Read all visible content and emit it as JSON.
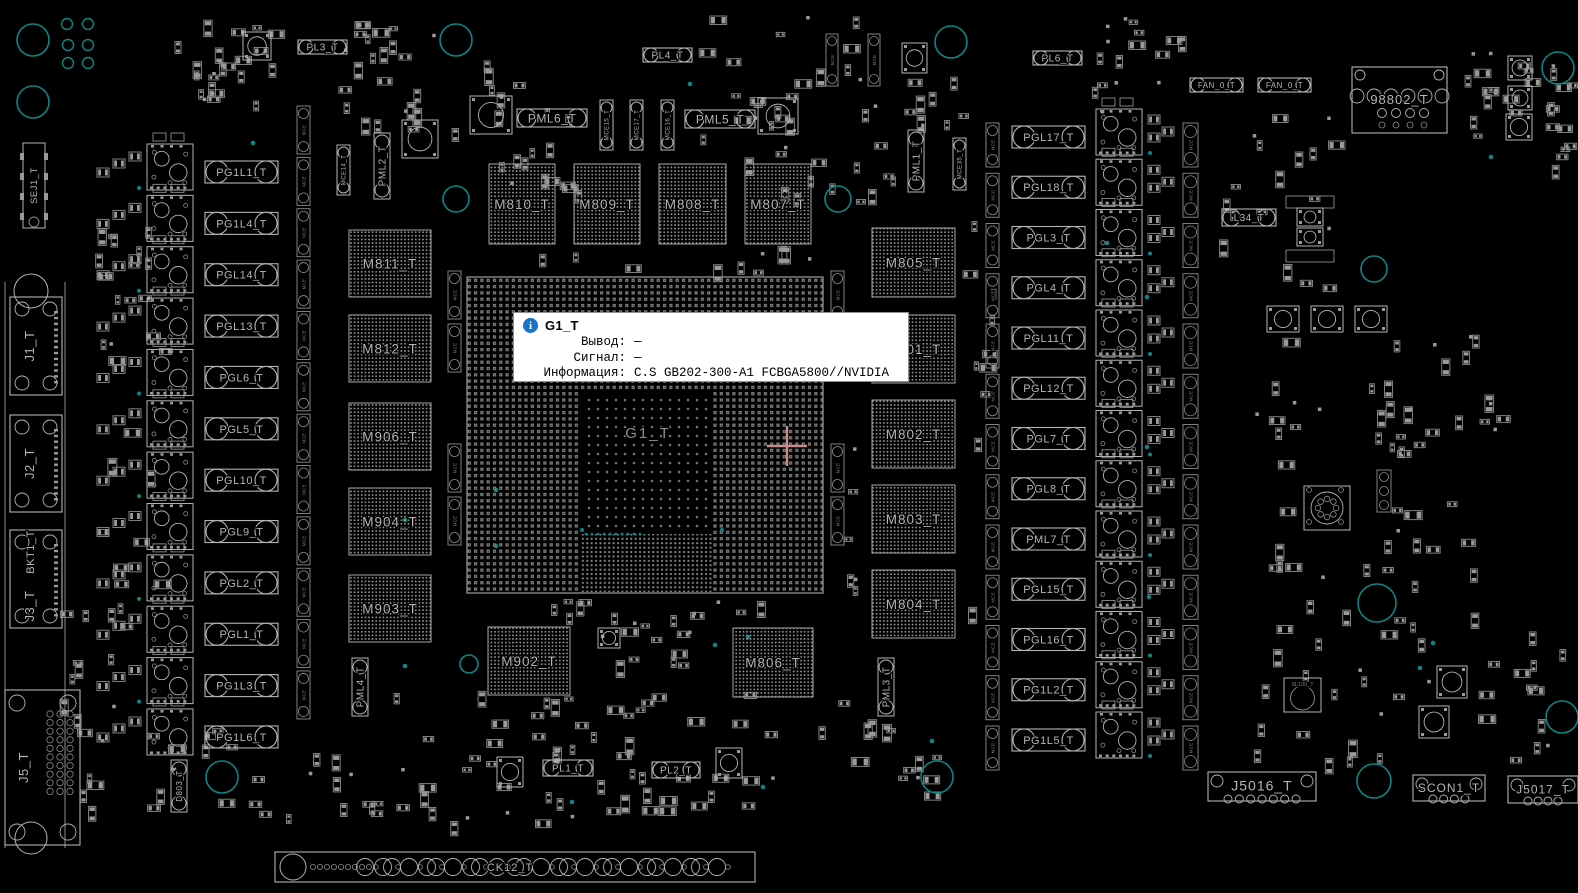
{
  "colors": {
    "bg": "#000000",
    "outline": "#b4b4b4",
    "dim": "#8d8d8d",
    "pad": "#9a9a9a",
    "label": "#b6b6b6",
    "faint": "#7e7e7e",
    "teal": "#0d8585",
    "crosshair": "#c98b8b",
    "tooltip_bg": "#ffffff",
    "tooltip_border": "#8f8f8f",
    "tooltip_text": "#000000",
    "info_icon_bg": "#1774c9"
  },
  "tooltip": {
    "x": 513,
    "y": 312,
    "w": 396,
    "h": 70,
    "title": "G1_T",
    "rows": [
      {
        "label": "Вывод:",
        "value": "—"
      },
      {
        "label": "Сигнал:",
        "value": "—"
      },
      {
        "label": "Информация:",
        "value": "C.S GB202-300-A1 FCBGA5800//NVIDIA"
      }
    ]
  },
  "gpu": {
    "label": "G1_T",
    "x": 467,
    "y": 277,
    "w": 356,
    "h": 316,
    "die": {
      "x": 580,
      "y": 390,
      "w": 132,
      "h": 142
    },
    "fine": {
      "x": 580,
      "y": 532,
      "w": 132,
      "h": 60
    },
    "crosshair": {
      "x": 787,
      "y": 446,
      "arm": 20
    }
  },
  "memory": [
    {
      "label": "M810_T",
      "x": 489,
      "y": 164,
      "w": 66,
      "h": 80
    },
    {
      "label": "M809_T",
      "x": 574,
      "y": 164,
      "w": 66,
      "h": 80
    },
    {
      "label": "M808_T",
      "x": 659,
      "y": 164,
      "w": 67,
      "h": 80
    },
    {
      "label": "M807_T",
      "x": 745,
      "y": 164,
      "w": 66,
      "h": 80
    },
    {
      "label": "M811_T",
      "x": 349,
      "y": 230,
      "w": 82,
      "h": 67
    },
    {
      "label": "M812_T",
      "x": 349,
      "y": 315,
      "w": 82,
      "h": 67
    },
    {
      "label": "M906_T",
      "x": 349,
      "y": 403,
      "w": 82,
      "h": 67
    },
    {
      "label": "M904_T",
      "x": 349,
      "y": 488,
      "w": 82,
      "h": 67
    },
    {
      "label": "M903_T",
      "x": 349,
      "y": 575,
      "w": 82,
      "h": 67
    },
    {
      "label": "M805_T",
      "x": 872,
      "y": 228,
      "w": 83,
      "h": 69
    },
    {
      "label": "M801_T",
      "x": 872,
      "y": 315,
      "w": 83,
      "h": 68
    },
    {
      "label": "M802_T",
      "x": 872,
      "y": 400,
      "w": 83,
      "h": 68
    },
    {
      "label": "M803_T",
      "x": 872,
      "y": 485,
      "w": 83,
      "h": 68
    },
    {
      "label": "M804_T",
      "x": 872,
      "y": 570,
      "w": 83,
      "h": 68
    },
    {
      "label": "M902_T",
      "x": 488,
      "y": 627,
      "w": 82,
      "h": 68
    },
    {
      "label": "M806_T",
      "x": 733,
      "y": 628,
      "w": 80,
      "h": 69
    }
  ],
  "left_phases": {
    "pill_x": 205,
    "pill_w": 73,
    "pill_h": 22,
    "drmos_x": 147,
    "y0": 172,
    "step": 51.36,
    "labels": [
      "PG1L1_T",
      "PG1L4_T",
      "PGL14_T",
      "PGL13_T",
      "PGL6_T",
      "PGL5_T",
      "PGL10_T",
      "PGL9_T",
      "PGL2_T",
      "PGL1_T",
      "PG1L3_T",
      "PG1L6_T"
    ]
  },
  "right_phases": {
    "pill_x": 1012,
    "pill_w": 73,
    "pill_h": 22,
    "drmos_x": 1096,
    "y0": 137,
    "step": 50.25,
    "labels": [
      "PGL17_T",
      "PGL18_T",
      "PGL3_T",
      "PGL4_T",
      "PGL11_T",
      "PGL12_T",
      "PGL7_T",
      "PGL8_T",
      "PML7_T",
      "PGL15_T",
      "PGL16_T",
      "PG1L2_T",
      "PG1L5_T"
    ]
  },
  "pills": [
    {
      "label": "PL3_T",
      "x": 298,
      "y": 40,
      "w": 49,
      "h": 14,
      "fs": 10
    },
    {
      "label": "PL4_T",
      "x": 643,
      "y": 48,
      "w": 49,
      "h": 14,
      "fs": 10
    },
    {
      "label": "PL6_T",
      "x": 1033,
      "y": 51,
      "w": 49,
      "h": 14,
      "fs": 10
    },
    {
      "label": "PML6_T",
      "x": 517,
      "y": 109,
      "w": 70,
      "h": 18,
      "fs": 12
    },
    {
      "label": "PML5_T",
      "x": 685,
      "y": 110,
      "w": 70,
      "h": 18,
      "fs": 12
    },
    {
      "label": "PL1_T",
      "x": 543,
      "y": 760,
      "w": 50,
      "h": 16,
      "fs": 10
    },
    {
      "label": "PL2_T",
      "x": 652,
      "y": 762,
      "w": 48,
      "h": 16,
      "fs": 10
    },
    {
      "label": "FAN_0_T",
      "x": 1190,
      "y": 78,
      "w": 53,
      "h": 14,
      "fs": 8
    },
    {
      "label": "FAN_0_T",
      "x": 1258,
      "y": 78,
      "w": 53,
      "h": 14,
      "fs": 8
    },
    {
      "label": "L34_T",
      "x": 1222,
      "y": 209,
      "w": 54,
      "h": 17,
      "fs": 10
    }
  ],
  "vpills": [
    {
      "label": "PML2_T",
      "x": 374,
      "y": 133,
      "w": 16,
      "h": 66,
      "fs": 10
    },
    {
      "label": "PML1_T",
      "x": 908,
      "y": 130,
      "w": 16,
      "h": 62,
      "fs": 10
    },
    {
      "label": "PML4_T",
      "x": 352,
      "y": 658,
      "w": 16,
      "h": 58,
      "fs": 10
    },
    {
      "label": "PML3_T",
      "x": 878,
      "y": 658,
      "w": 16,
      "h": 58,
      "fs": 10
    },
    {
      "label": "D803_T",
      "x": 171,
      "y": 760,
      "w": 16,
      "h": 52,
      "fs": 8
    },
    {
      "label": "MCE15_T",
      "x": 600,
      "y": 100,
      "w": 13,
      "h": 50,
      "fs": 6
    },
    {
      "label": "MCE17_T",
      "x": 630,
      "y": 100,
      "w": 13,
      "h": 50,
      "fs": 6
    },
    {
      "label": "MCE16_T",
      "x": 661,
      "y": 100,
      "w": 13,
      "h": 50,
      "fs": 6
    },
    {
      "label": "MCE14_T",
      "x": 337,
      "y": 145,
      "w": 13,
      "h": 50,
      "fs": 6
    },
    {
      "label": "MCE35_T",
      "x": 953,
      "y": 138,
      "w": 13,
      "h": 52,
      "fs": 6
    }
  ],
  "cap_generic_label": "MCE",
  "cap_columns": [
    {
      "x": 297,
      "w": 13,
      "h": 48,
      "y0": 130,
      "step": 51.36,
      "n": 12
    },
    {
      "x": 986,
      "w": 13,
      "h": 44,
      "y0": 145,
      "step": 50.25,
      "n": 13
    },
    {
      "x": 1183,
      "w": 15,
      "h": 44,
      "y0": 145,
      "step": 50.25,
      "n": 13
    },
    {
      "x": 448,
      "w": 13,
      "h": 48,
      "ys": [
        295,
        348,
        468,
        521
      ]
    },
    {
      "x": 831,
      "w": 13,
      "h": 48,
      "ys": [
        295,
        348,
        468,
        521
      ]
    },
    {
      "x": 826,
      "w": 12,
      "h": 52,
      "ys": [
        60
      ]
    },
    {
      "x": 868,
      "w": 12,
      "h": 52,
      "ys": [
        60
      ]
    }
  ],
  "connectors": {
    "sej1": {
      "label": "SEJ1_T",
      "x": 23,
      "y": 143,
      "w": 22,
      "h": 85
    },
    "bracket": {
      "label": "BKT1_T",
      "x1": 5,
      "x2": 65,
      "y1": 282,
      "y2": 848
    },
    "j_list": [
      {
        "label": "J1_T",
        "x": 10,
        "y": 297,
        "w": 52,
        "h": 98
      },
      {
        "label": "J2_T",
        "x": 10,
        "y": 415,
        "w": 52,
        "h": 97
      },
      {
        "label": "J3_T",
        "x": 10,
        "y": 530,
        "w": 52,
        "h": 98,
        "extra": "BKT1_T"
      }
    ],
    "j5": {
      "label": "J5_T",
      "x": 5,
      "y": 690,
      "w": 75,
      "h": 155
    },
    "j8802": {
      "label": "98802_T",
      "x": 1352,
      "y": 67,
      "w": 95,
      "h": 66
    },
    "sl100": {
      "label": "SL100_T",
      "x": 1284,
      "y": 678,
      "w": 37,
      "h": 34
    },
    "bottom": [
      {
        "label": "J5016_T",
        "x": 1208,
        "y": 772,
        "w": 108,
        "h": 29,
        "rings": 7,
        "fs": 14
      },
      {
        "label": "SCON1_T",
        "x": 1413,
        "y": 775,
        "w": 72,
        "h": 26,
        "rings": 4,
        "fs": 12
      },
      {
        "label": "J5017_T",
        "x": 1508,
        "y": 776,
        "w": 70,
        "h": 27,
        "rings": 4,
        "fs": 12
      }
    ],
    "edge": {
      "label": "CK12_T",
      "x": 275,
      "y": 852,
      "w": 480,
      "h": 30
    }
  },
  "holes": {
    "large": [
      [
        33,
        40,
        16
      ],
      [
        33,
        102,
        16
      ],
      [
        456,
        40,
        16
      ],
      [
        951,
        42,
        16
      ],
      [
        1558,
        68,
        16
      ],
      [
        456,
        199,
        13
      ],
      [
        838,
        199,
        13
      ],
      [
        1374,
        269,
        13
      ],
      [
        222,
        777,
        16
      ],
      [
        937,
        777,
        16
      ],
      [
        1374,
        781,
        17
      ],
      [
        1562,
        717,
        16
      ],
      [
        1377,
        603,
        19
      ],
      [
        469,
        664,
        9
      ]
    ],
    "rings": [
      [
        67,
        24,
        5.5
      ],
      [
        88,
        24,
        5.5
      ],
      [
        68,
        45,
        5.5
      ],
      [
        88,
        45,
        5.5
      ],
      [
        68,
        63,
        5.5
      ],
      [
        88,
        63,
        5.5
      ]
    ],
    "dots": [
      [
        253,
        143
      ],
      [
        405,
        520
      ],
      [
        405,
        666
      ],
      [
        496,
        490
      ],
      [
        496,
        546
      ],
      [
        715,
        645
      ],
      [
        748,
        637
      ],
      [
        572,
        802
      ],
      [
        763,
        787
      ],
      [
        1107,
        243
      ],
      [
        1147,
        297
      ],
      [
        1147,
        447
      ],
      [
        1149,
        597
      ],
      [
        1433,
        643
      ],
      [
        1491,
        157
      ],
      [
        932,
        741
      ],
      [
        1420,
        668
      ],
      [
        690,
        84
      ]
    ]
  },
  "squares": [
    [
      470,
      96,
      42,
      38
    ],
    [
      758,
      98,
      40,
      36
    ],
    [
      402,
      120,
      36,
      38
    ],
    [
      243,
      32,
      28,
      28
    ],
    [
      902,
      43,
      25,
      30
    ],
    [
      497,
      757,
      26,
      30
    ],
    [
      716,
      748,
      26,
      30
    ],
    [
      598,
      628,
      22,
      20
    ],
    [
      1267,
      306,
      32,
      26
    ],
    [
      1311,
      306,
      32,
      26
    ],
    [
      1355,
      306,
      32,
      26
    ],
    [
      1437,
      666,
      30,
      32
    ],
    [
      1419,
      706,
      30,
      32
    ],
    [
      1508,
      56,
      24,
      24
    ],
    [
      1508,
      86,
      24,
      24
    ],
    [
      1506,
      114,
      26,
      26
    ],
    [
      1297,
      208,
      26,
      18
    ],
    [
      1297,
      228,
      26,
      18
    ]
  ],
  "strips": [
    [
      1286,
      196,
      48,
      12
    ],
    [
      1286,
      250,
      48,
      12
    ]
  ],
  "round_conn": [
    1304,
    486,
    46,
    44
  ],
  "ring_strip": [
    1377,
    470,
    14,
    42
  ],
  "scatter_regions": [
    {
      "x": 150,
      "y": 18,
      "w": 140,
      "h": 85,
      "n": 22,
      "seed": 11
    },
    {
      "x": 335,
      "y": 20,
      "w": 130,
      "h": 112,
      "n": 24,
      "seed": 12
    },
    {
      "x": 480,
      "y": 60,
      "w": 115,
      "h": 135,
      "n": 20,
      "seed": 13
    },
    {
      "x": 690,
      "y": 15,
      "w": 215,
      "h": 185,
      "n": 38,
      "seed": 14
    },
    {
      "x": 1090,
      "y": 15,
      "w": 110,
      "h": 100,
      "n": 16,
      "seed": 15
    },
    {
      "x": 1455,
      "y": 50,
      "w": 100,
      "h": 90,
      "n": 18,
      "seed": 16
    },
    {
      "x": 1550,
      "y": 55,
      "w": 26,
      "h": 145,
      "n": 8,
      "seed": 17
    },
    {
      "x": 1205,
      "y": 95,
      "w": 130,
      "h": 190,
      "n": 18,
      "seed": 18
    },
    {
      "x": 1255,
      "y": 335,
      "w": 245,
      "h": 250,
      "n": 52,
      "seed": 19
    },
    {
      "x": 1240,
      "y": 600,
      "w": 330,
      "h": 160,
      "n": 38,
      "seed": 20
    },
    {
      "x": 380,
      "y": 690,
      "w": 400,
      "h": 140,
      "n": 58,
      "seed": 21
    },
    {
      "x": 60,
      "y": 600,
      "w": 78,
      "h": 230,
      "n": 18,
      "seed": 22
    },
    {
      "x": 140,
      "y": 728,
      "w": 88,
      "h": 78,
      "n": 10,
      "seed": 23
    },
    {
      "x": 240,
      "y": 745,
      "w": 140,
      "h": 72,
      "n": 14,
      "seed": 24
    },
    {
      "x": 92,
      "y": 190,
      "w": 70,
      "h": 420,
      "n": 26,
      "seed": 25
    },
    {
      "x": 830,
      "y": 210,
      "w": 28,
      "h": 440,
      "n": 8,
      "seed": 26
    },
    {
      "x": 955,
      "y": 210,
      "w": 42,
      "h": 440,
      "n": 10,
      "seed": 27
    },
    {
      "x": 480,
      "y": 245,
      "w": 340,
      "h": 28,
      "n": 10,
      "seed": 28
    },
    {
      "x": 480,
      "y": 598,
      "w": 340,
      "h": 44,
      "n": 12,
      "seed": 29
    },
    {
      "x": 585,
      "y": 612,
      "w": 100,
      "h": 52,
      "n": 12,
      "seed": 30
    },
    {
      "x": 818,
      "y": 680,
      "w": 120,
      "h": 115,
      "n": 14,
      "seed": 31
    },
    {
      "x": 890,
      "y": 60,
      "w": 70,
      "h": 70,
      "n": 9,
      "seed": 32
    }
  ]
}
